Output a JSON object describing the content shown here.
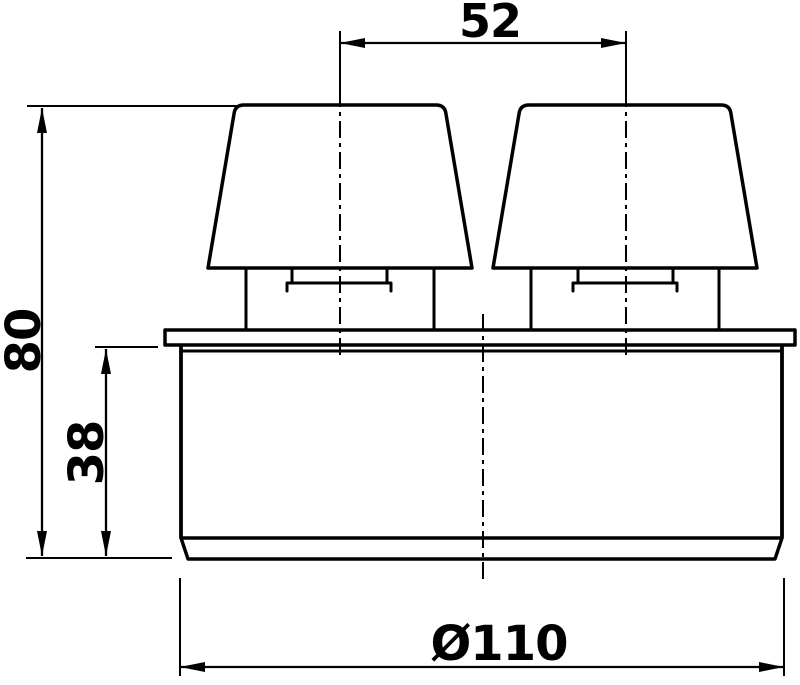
{
  "drawing": {
    "description": "Technical dimension drawing, front elevation of a pipe vent part with two conical caps on a flanged cylindrical socket",
    "background_color": "#ffffff",
    "line_color": "#000000",
    "dimensions": {
      "cap_spacing": "52",
      "overall_height": "80",
      "socket_height": "38",
      "diameter": "Ø110"
    }
  }
}
